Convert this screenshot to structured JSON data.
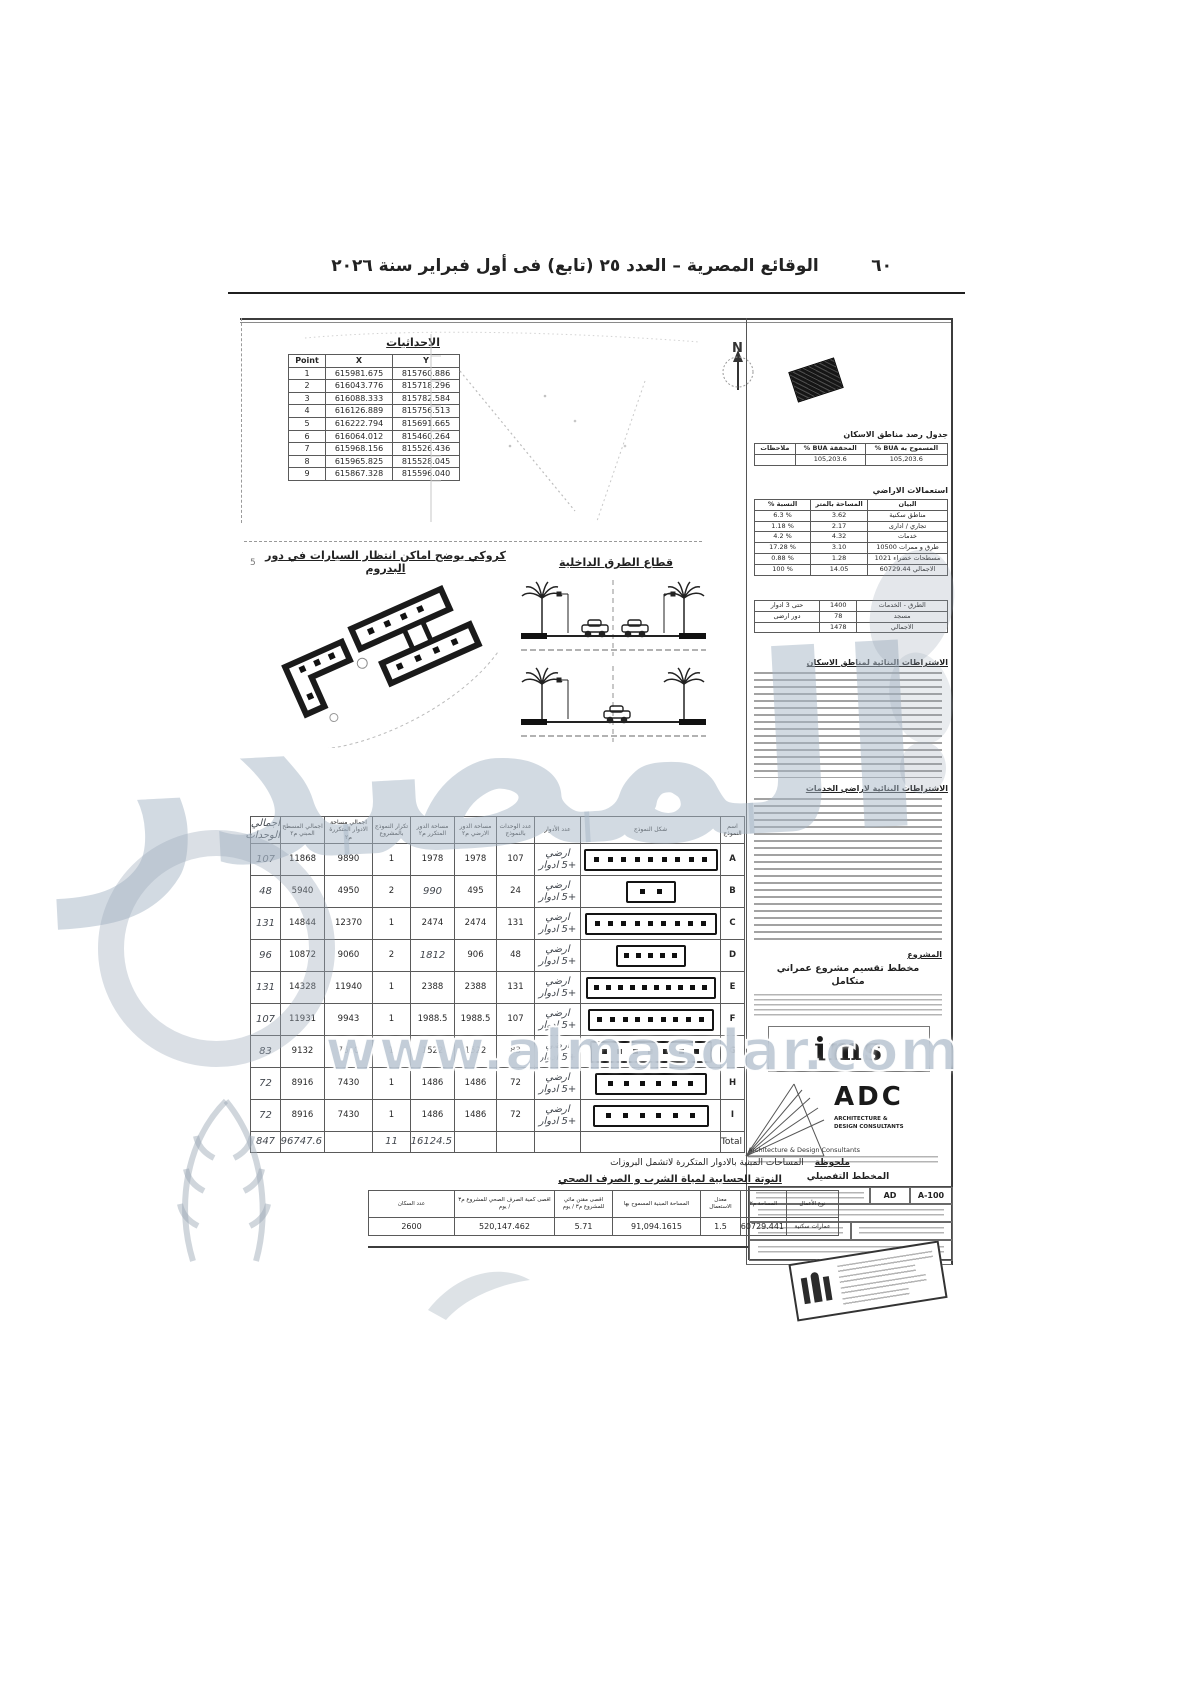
{
  "page_header": {
    "title": "الوقائع المصرية – العدد ٢٥ (تابع) فى أول فبراير سنة ٢٠٢٦",
    "page_number": "٦٠"
  },
  "margin_mark": "5",
  "coordinates": {
    "title": "الاحداثيات",
    "headers": [
      "Point",
      "X",
      "Y"
    ],
    "rows": [
      [
        "1",
        "615981.675",
        "815760.886"
      ],
      [
        "2",
        "616043.776",
        "815718.296"
      ],
      [
        "3",
        "616088.333",
        "815782.584"
      ],
      [
        "4",
        "616126.889",
        "815756.513"
      ],
      [
        "5",
        "616222.794",
        "815691.665"
      ],
      [
        "6",
        "616064.012",
        "815460.264"
      ],
      [
        "7",
        "615968.156",
        "815526.436"
      ],
      [
        "8",
        "615965.825",
        "815528.045"
      ],
      [
        "9",
        "615867.328",
        "815596.040"
      ]
    ]
  },
  "north_label": "N",
  "parking_sketch": {
    "title": "كروكي يوضح اماكن انتظار السيارات في دور البدروم"
  },
  "roads_section": {
    "title": "قطاع الطرق الداخلية"
  },
  "right_panel": {
    "housing_title": "جدول رصد مناطق الاسكان",
    "bua_table": {
      "headers": [
        "المسموح به BUA %",
        "المحققة BUA %",
        "ملاحظات"
      ],
      "values": [
        "105,203.6",
        "105,203.6",
        ""
      ]
    },
    "landuse_title": "استعمالات الاراضي",
    "landuse": {
      "headers": [
        "البيان",
        "المساحة بالمتر",
        "النسبة %"
      ],
      "rows": [
        [
          "مناطق سكنية",
          "3.62",
          "% 6.3"
        ],
        [
          "تجاري / ادارى",
          "2.17",
          "% 1.18"
        ],
        [
          "خدمات",
          "4.32",
          "% 4.2"
        ],
        [
          "طرق و ممرات 10500",
          "3.10",
          "% 17.28"
        ],
        [
          "مسطحات خضراء 1021",
          "1.28",
          "% 0.88"
        ],
        [
          "الاجمالي 60729.44",
          "14.05",
          "% 100"
        ]
      ]
    },
    "services": {
      "rows": [
        [
          "الطرق - الخدمات",
          "1400",
          "حتى 3 ادوار"
        ],
        [
          "مسجد",
          "78",
          "دور ارضى"
        ],
        [
          "الاجمالي",
          "1478",
          ""
        ]
      ]
    },
    "housing_req_title": "الاشتراطات البنائية لمناطق الاسكان",
    "services_req_title": "الاشتراطات البنائية لاراضي الخدمات",
    "project_label": "المشروع",
    "project_title": "مخطط تقسيم مشروع عمراني",
    "project_title2": "متكامل",
    "ims_logo": "ims",
    "adc": {
      "name": "ADC",
      "sub1": "ARCHITECTURE &",
      "sub2": "DESIGN CONSULTANTS",
      "sub3": "Architecture & Design Consultants"
    },
    "detail_plan_title": "المخطط التفصيلي",
    "sheet_code": "AD",
    "sheet_no": "A-100"
  },
  "models_table": {
    "headers": {
      "name": "اسم النموذج",
      "shape": "شكل النموذج",
      "floors": "عدد الأدوار",
      "units": "عدد الوحدات بالنموذج",
      "ground": "مساحة الدور الارضي م٢",
      "typical": "مساحة الدور المتكرر م٢",
      "repeat": "تكرار النموذج بالمشروع",
      "total_typical": "اجمالي مساحة الادوار المتكررة م٢",
      "built": "اجمالي المسطح المبني م٢",
      "hw_total": "اجمالي الوحدات"
    },
    "floors_value": "ارضي +5 ادوار",
    "rows": [
      {
        "name": "A",
        "units": "107",
        "ground": "1978",
        "typical": "1978",
        "repeat": "1",
        "total_typical": "9890",
        "built": "11868",
        "hw_total": "107",
        "squares": 9,
        "w": 130
      },
      {
        "name": "B",
        "units": "24",
        "ground": "495",
        "typical": "990",
        "typical_hw": true,
        "repeat": "2",
        "total_typical": "4950",
        "built": "5940",
        "hw_total": "48",
        "squares": 2,
        "w": 46
      },
      {
        "name": "C",
        "units": "131",
        "ground": "2474",
        "typical": "2474",
        "repeat": "1",
        "total_typical": "12370",
        "built": "14844",
        "hw_total": "131",
        "squares": 9,
        "w": 128
      },
      {
        "name": "D",
        "units": "48",
        "ground": "906",
        "typical": "1812",
        "typical_hw": true,
        "repeat": "2",
        "total_typical": "9060",
        "built": "10872",
        "hw_total": "96",
        "squares": 5,
        "w": 66
      },
      {
        "name": "E",
        "units": "131",
        "ground": "2388",
        "typical": "2388",
        "repeat": "1",
        "total_typical": "11940",
        "built": "14328",
        "hw_total": "131",
        "squares": 10,
        "w": 126
      },
      {
        "name": "F",
        "units": "107",
        "ground": "1988.5",
        "typical": "1988.5",
        "repeat": "1",
        "total_typical": "9943",
        "built": "11931",
        "hw_total": "107",
        "squares": 9,
        "w": 122
      },
      {
        "name": "G",
        "units": "83",
        "ground": "1522",
        "typical": "1522",
        "repeat": "1",
        "total_typical": "7610",
        "built": "9132",
        "hw_total": "83",
        "squares": 7,
        "w": 118
      },
      {
        "name": "H",
        "units": "72",
        "ground": "1486",
        "typical": "1486",
        "repeat": "1",
        "total_typical": "7430",
        "built": "8916",
        "hw_total": "72",
        "squares": 6,
        "w": 108
      },
      {
        "name": "I",
        "units": "72",
        "ground": "1486",
        "typical": "1486",
        "repeat": "1",
        "total_typical": "7430",
        "built": "8916",
        "hw_total": "72",
        "squares": 6,
        "w": 112
      }
    ],
    "total": {
      "label": "Total",
      "typical": "16124.5",
      "repeat": "11",
      "built": "96747.6",
      "hw_total": "847"
    }
  },
  "note": {
    "label": "ملحوظة",
    "text": "المساحات المبنية بالادوار المتكررة لاتشمل البروزات"
  },
  "water_calc": {
    "title": "النوتة الحسابية لمياة الشرب و الصرف الصحي",
    "headers": [
      "نوع الأعمال",
      "المساحة م٢",
      "معدل الاستعمال",
      "المساحة المبنية المسموح بها",
      "اقصى مقنن مائي للمشروع م٣ / يوم",
      "اقصى كمية الصرف الصحي للمشروع م٣ / يوم",
      "عدد السكان"
    ],
    "values": [
      "عمارات سكنية",
      "60729.441",
      "1.5",
      "91,094.1615",
      "5.71",
      "520,147.462",
      "2600"
    ]
  },
  "watermark": {
    "text": "المصدر",
    "url": "www.almasdar.com"
  }
}
